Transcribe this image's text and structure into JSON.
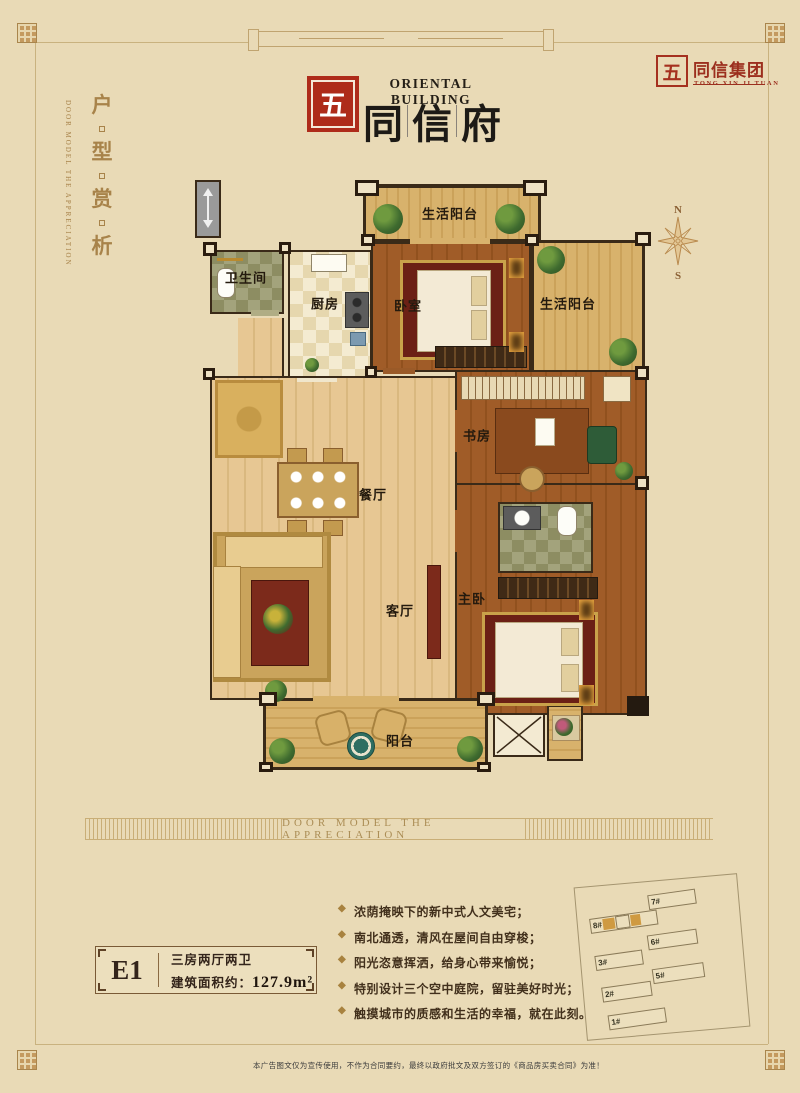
{
  "page": {
    "background": "#e9dab6",
    "disclaimer": "本广告图文仅为宣传使用，不作为合同要约，最终以政府批文及双方签订的《商品房买卖合同》为准！"
  },
  "colors": {
    "seal_red": "#ae2b1a",
    "gold": "#a8834a",
    "site_highlight": "#cf9a41"
  },
  "header": {
    "brand_en": "ORIENTAL BUILDING",
    "brand_cn_chars": [
      "同",
      "信",
      "府"
    ],
    "seal_char": "五",
    "group_cn": "同信集团",
    "group_en": "TONG XIN JI TUAN"
  },
  "side_title": {
    "chars": [
      "户",
      "型",
      "赏",
      "析"
    ],
    "en": "DOOR MODEL THE APPRECIATION"
  },
  "compass": {
    "north": "N",
    "south": "S"
  },
  "floorplan": {
    "labels": {
      "balcony_top": "生活阳台",
      "bedroom2": "卧室",
      "balcony_right": "生活阳台",
      "bathroom": "卫生间",
      "kitchen": "厨房",
      "study": "书房",
      "dining": "餐厅",
      "living": "客厅",
      "master": "主卧",
      "balcony_bottom": "阳台"
    }
  },
  "banner": {
    "text": "DOOR MODEL THE APPRECIATION"
  },
  "unit_info": {
    "code": "E1",
    "layout": "三房两厅两卫",
    "area_label": "建筑面积约：",
    "area_value": "127.9m²"
  },
  "features": [
    "浓荫掩映下的新中式人文美宅；",
    "南北通透，清风在屋间自由穿梭；",
    "阳光恣意挥洒，给身心带来愉悦；",
    "特别设计三个空中庭院，留驻美好时光；",
    "触摸城市的质感和生活的幸福，就在此刻。"
  ],
  "siteplan": {
    "buildings": [
      {
        "label": "7#"
      },
      {
        "label": "8#",
        "highlight": true
      },
      {
        "label": "6#"
      },
      {
        "label": "3#"
      },
      {
        "label": "5#"
      },
      {
        "label": "2#"
      },
      {
        "label": "1#"
      }
    ]
  }
}
